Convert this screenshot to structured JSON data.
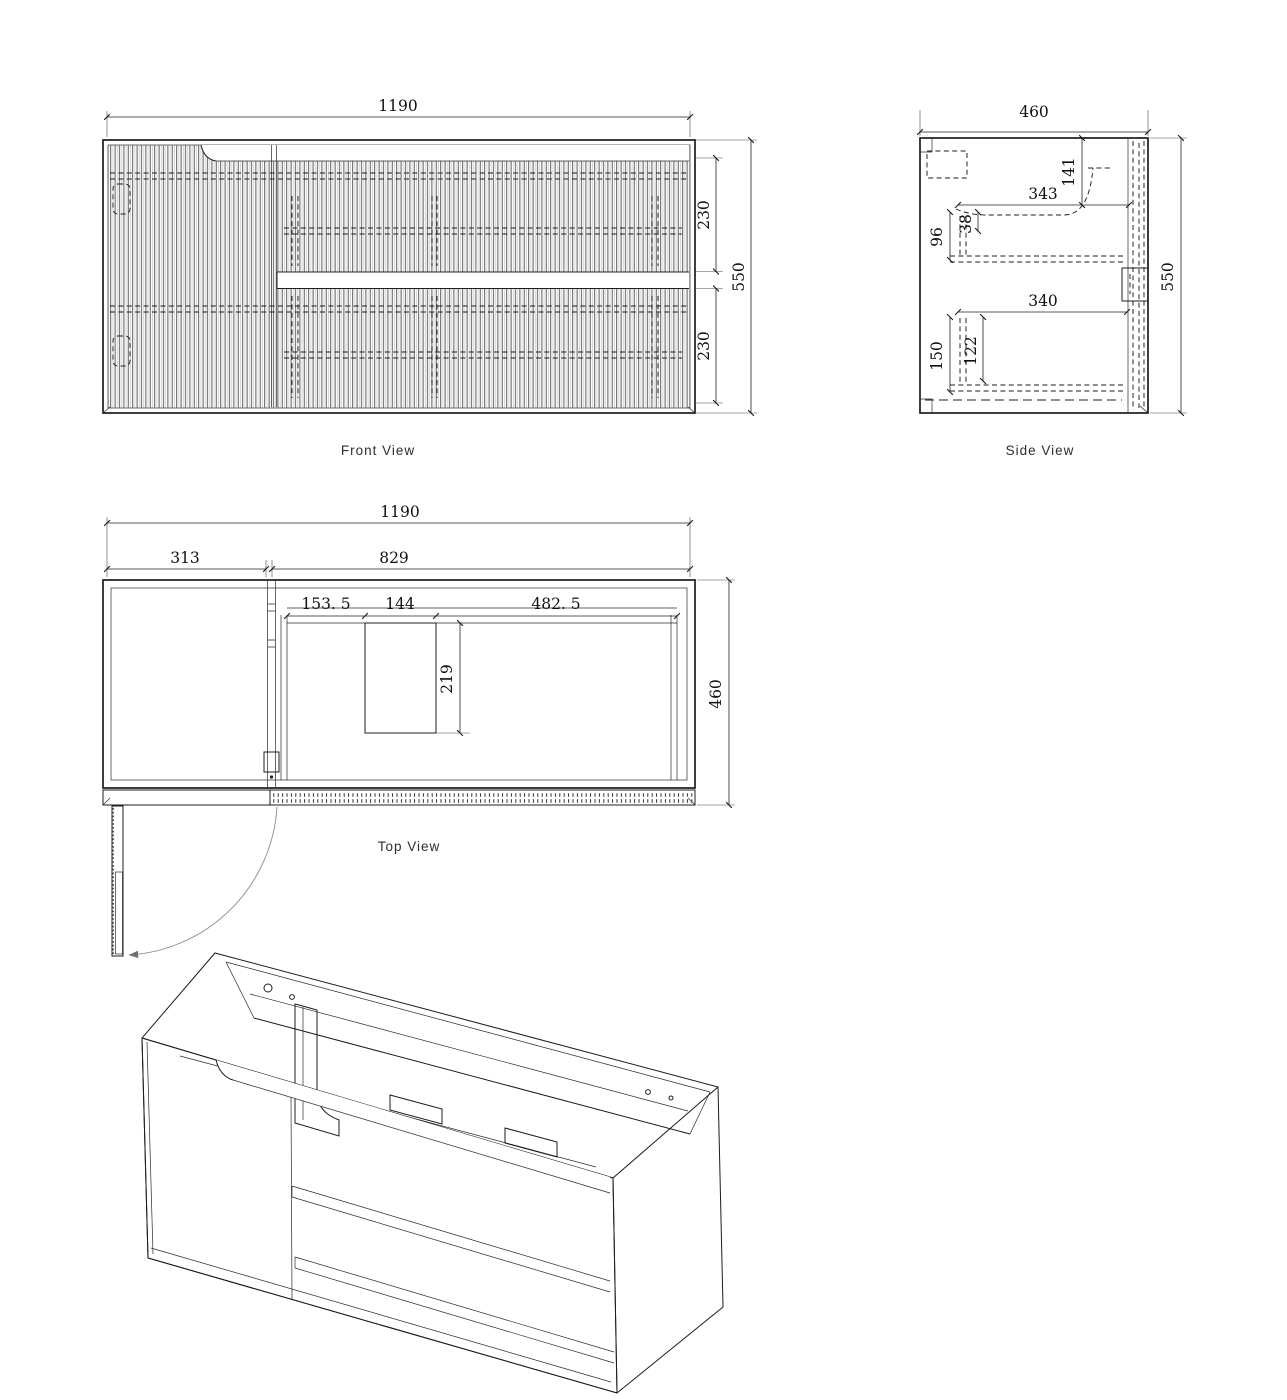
{
  "drawing": {
    "views": {
      "front": {
        "label": "Front View",
        "dims": {
          "width": "1190",
          "height": "550",
          "drawer_top": "230",
          "drawer_bottom": "230"
        }
      },
      "side": {
        "label": "Side View",
        "dims": {
          "depth": "460",
          "height": "550",
          "basin_width": "343",
          "basin_depth": "141",
          "rail_offset": "96",
          "rail_gap": "38",
          "shelf_width": "340",
          "bottom_offset": "150",
          "bottom_inner": "122"
        }
      },
      "top": {
        "label": "Top View",
        "dims": {
          "width": "1190",
          "door_width": "313",
          "drawers_width": "829",
          "offset_left": "153. 5",
          "cutout_width": "144",
          "offset_right": "482. 5",
          "cutout_depth": "219",
          "depth": "460"
        }
      },
      "isometric": {
        "label": ""
      }
    },
    "colors": {
      "line": "#1c1c1c",
      "dim_text": "#101010",
      "label_text": "#2e2e2e",
      "swing_arc": "#8a8a8a",
      "background": "#ffffff"
    }
  }
}
